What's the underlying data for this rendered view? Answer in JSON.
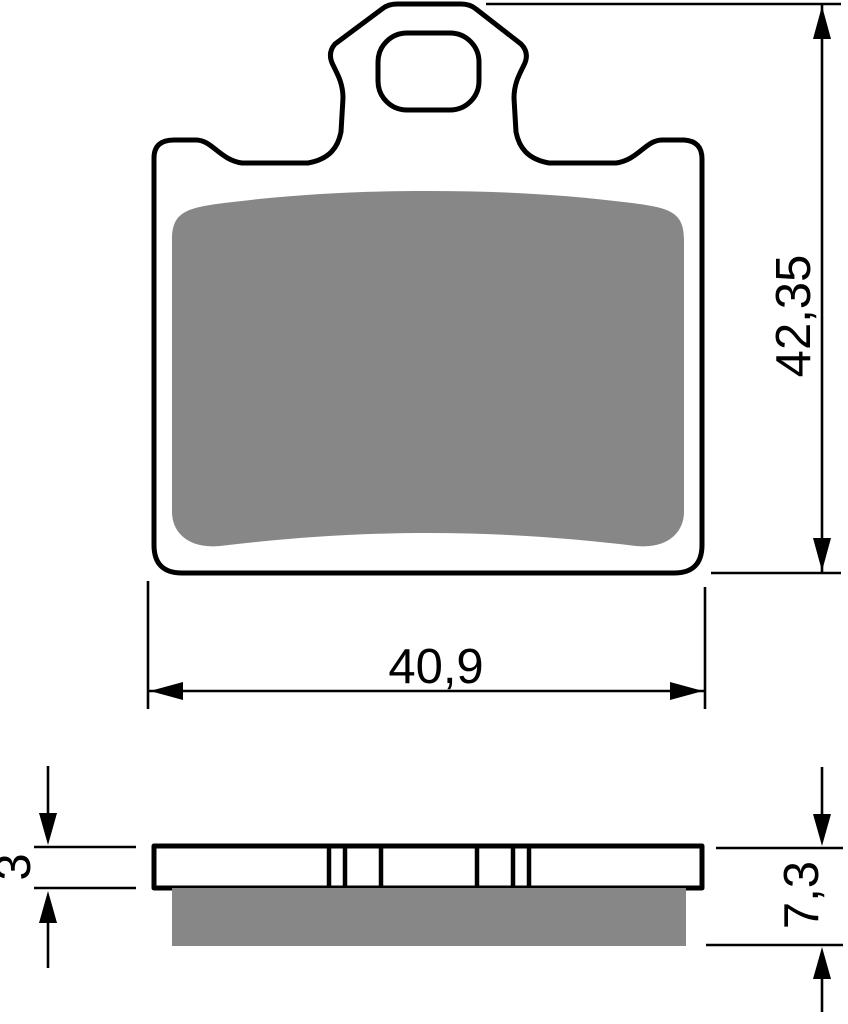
{
  "drawing": {
    "dimensions": {
      "pad_height": "42,35",
      "pad_width": "40,9",
      "backplate_thickness": "3",
      "total_thickness": "7,3"
    },
    "colors": {
      "outline": "#000000",
      "friction_material": "#878787",
      "background": "#ffffff"
    }
  }
}
